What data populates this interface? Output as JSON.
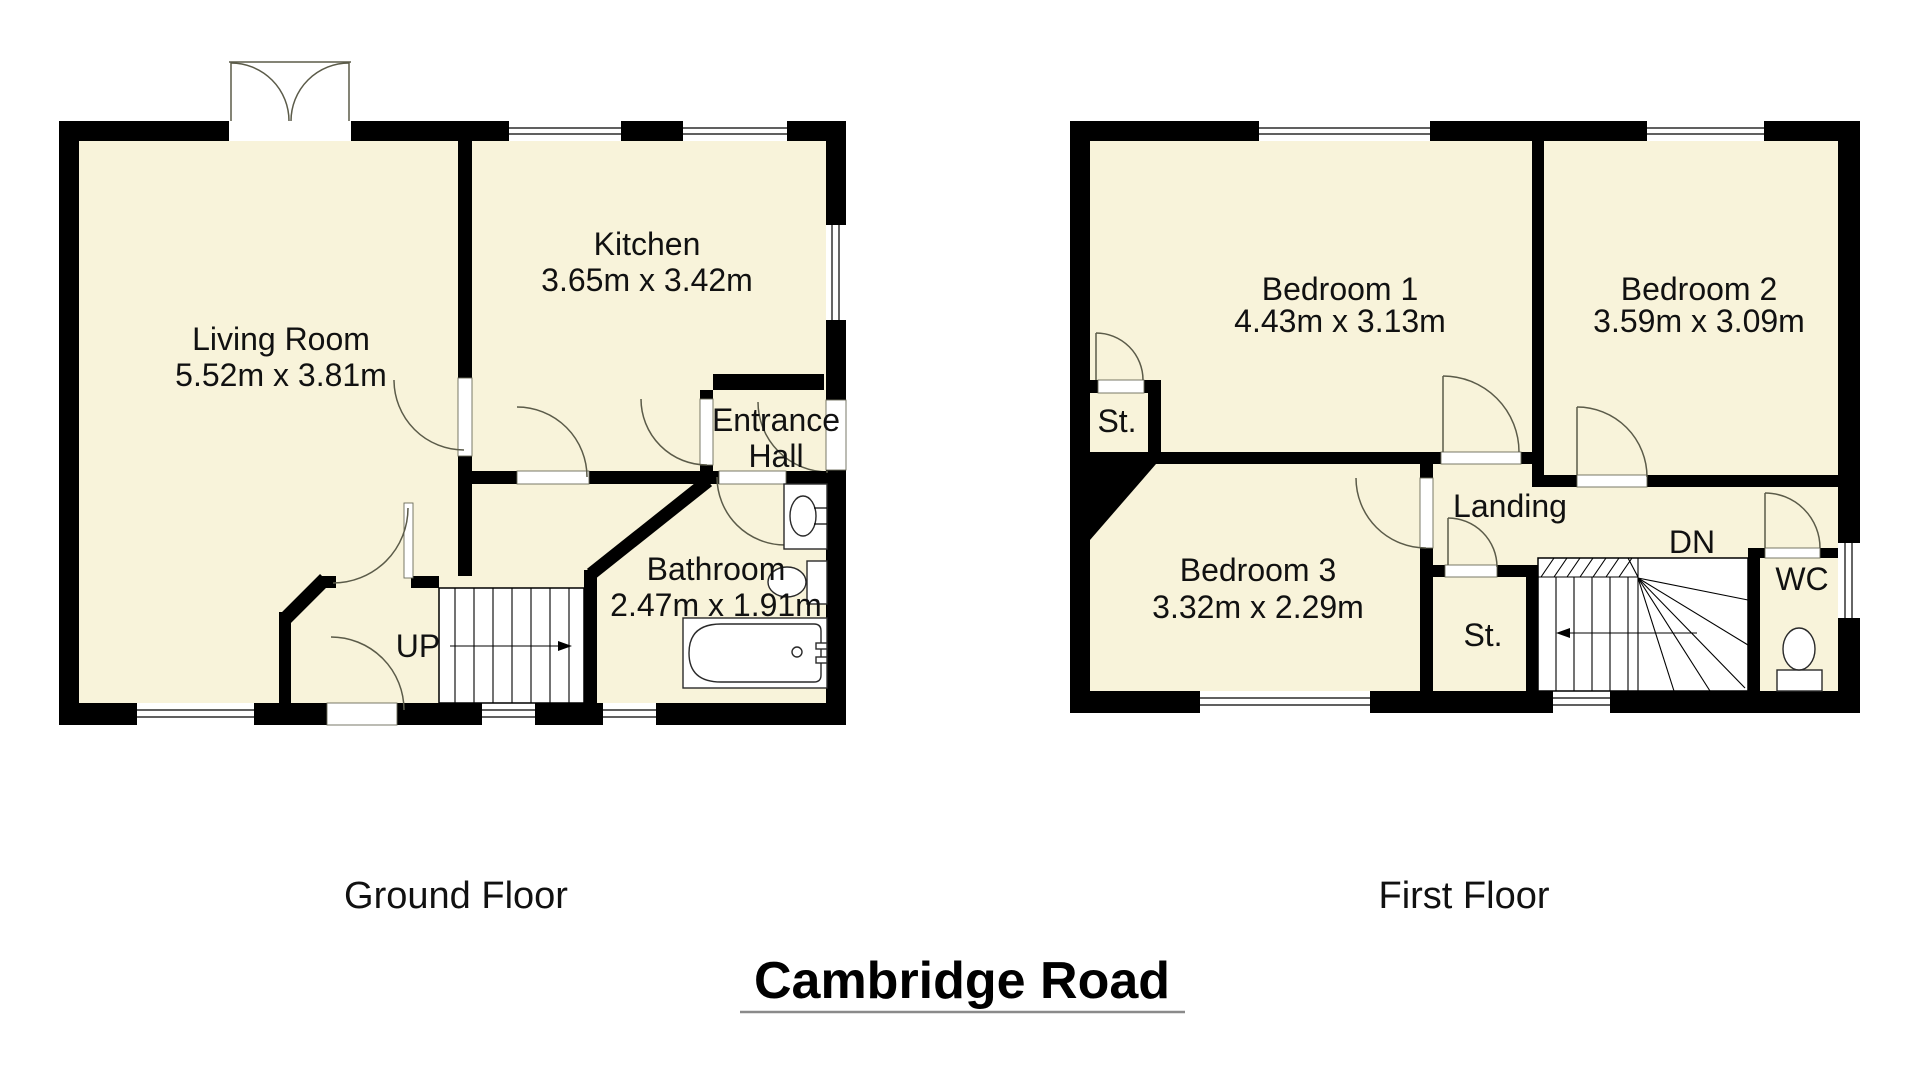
{
  "title": "Cambridge Road",
  "colors": {
    "background": "#ffffff",
    "wall": "#000000",
    "floor_fill": "#f8f3da",
    "door_arc": "#5b5b49",
    "text": "#111111"
  },
  "ground_floor": {
    "label": "Ground Floor",
    "rooms": {
      "living_room": {
        "name": "Living Room",
        "dims": "5.52m x 3.81m"
      },
      "kitchen": {
        "name": "Kitchen",
        "dims": "3.65m x 3.42m"
      },
      "entrance_hall": {
        "name_line1": "Entrance",
        "name_line2": "Hall"
      },
      "bathroom": {
        "name": "Bathroom",
        "dims": "2.47m x 1.91m"
      }
    },
    "stairs_label": "UP"
  },
  "first_floor": {
    "label": "First Floor",
    "rooms": {
      "bedroom1": {
        "name": "Bedroom 1",
        "dims": "4.43m x 3.13m"
      },
      "bedroom2": {
        "name": "Bedroom 2",
        "dims": "3.59m x 3.09m"
      },
      "bedroom3": {
        "name": "Bedroom 3",
        "dims": "3.32m x 2.29m"
      },
      "landing": {
        "name": "Landing"
      },
      "storage1": {
        "name": "St."
      },
      "storage2": {
        "name": "St."
      },
      "wc": {
        "name": "WC"
      }
    },
    "stairs_label": "DN"
  }
}
